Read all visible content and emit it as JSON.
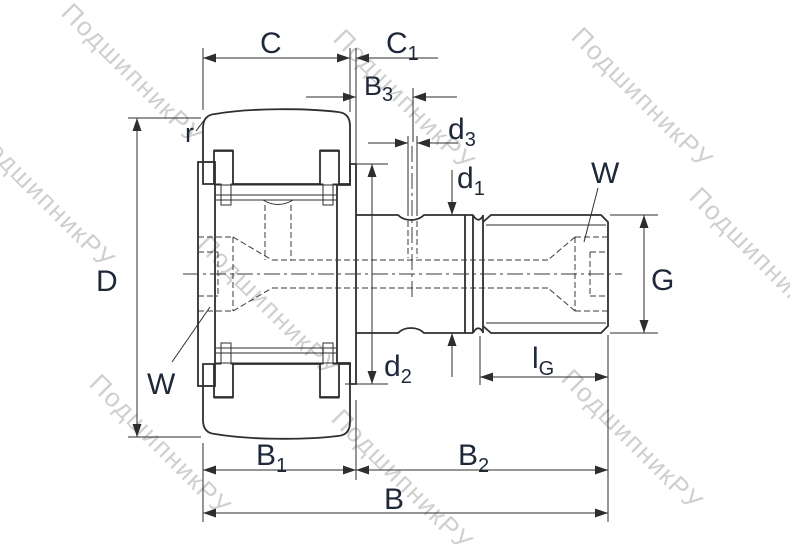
{
  "watermark": {
    "text": "ПодшипникРУ"
  },
  "colors": {
    "line": "#2e2e2e",
    "label": "#1e2839",
    "watermark": "rgba(128,128,128,0.38)"
  },
  "labels": {
    "C": {
      "base": "C",
      "sub": ""
    },
    "C1": {
      "base": "C",
      "sub": "1"
    },
    "B3": {
      "base": "B",
      "sub": "3"
    },
    "d3": {
      "base": "d",
      "sub": "3"
    },
    "d1": {
      "base": "d",
      "sub": "1"
    },
    "W_right": {
      "base": "W",
      "sub": ""
    },
    "G": {
      "base": "G",
      "sub": ""
    },
    "lG": {
      "base": "l",
      "sub": "G"
    },
    "d2": {
      "base": "d",
      "sub": "2"
    },
    "W_left": {
      "base": "W",
      "sub": ""
    },
    "B1": {
      "base": "B",
      "sub": "1"
    },
    "B2": {
      "base": "B",
      "sub": "2"
    },
    "B": {
      "base": "B",
      "sub": ""
    },
    "D": {
      "base": "D",
      "sub": ""
    },
    "r": {
      "base": "r",
      "sub": ""
    }
  }
}
